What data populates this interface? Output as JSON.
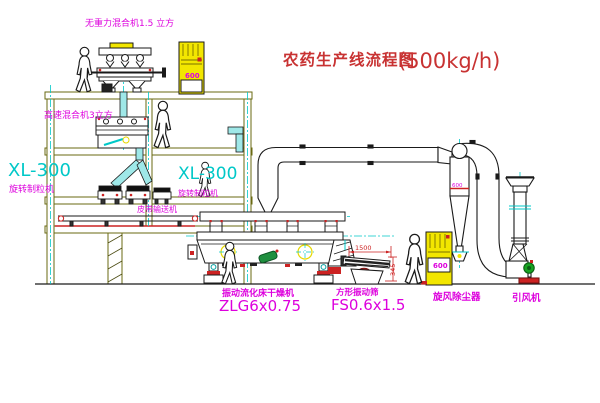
{
  "title": {
    "main": "农药生产线流程图",
    "capacity": "(500kg/h)"
  },
  "labels": {
    "top_mixer": "无重力混合机1.5 立方",
    "floor2_mixer": "高速混合机3立方",
    "xl300_left": "XL-300",
    "xl300_left_sub": "旋转制粒机",
    "xl300_mid": "XL-300",
    "xl300_mid_sub": "旋转制粒机",
    "belt_conveyor": "皮带输送机",
    "dryer_name": "振动流化床干燥机",
    "dryer_model": "ZLG6x0.75",
    "sieve_name": "方形振动筛",
    "sieve_model": "FS0.6x1.5",
    "cyclone_name": "旋风除尘器",
    "fan_name": "引风机"
  },
  "dimensions": {
    "sieve_length": "1500",
    "sieve_height": "345",
    "cyclone_width": "600",
    "cabinet_a": "600",
    "cabinet_b": "600"
  },
  "colors": {
    "label_magenta": "#dd00dd",
    "model_cyan": "#00c8c8",
    "title_red": "#c83232",
    "machine_yellow": "#f2e600",
    "line_black": "#1a1a1a",
    "structure_olive": "#6a6a12",
    "detail_red": "#cc2222",
    "motor_green": "#1f8f3f"
  }
}
